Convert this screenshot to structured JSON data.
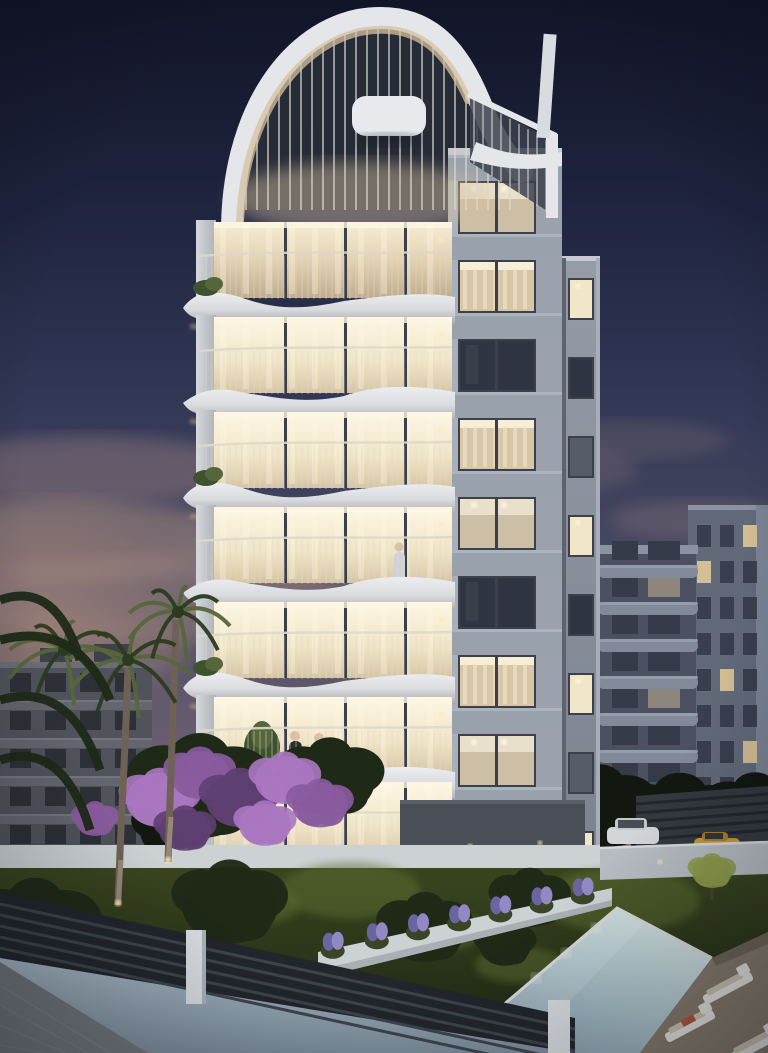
{
  "scene": {
    "type": "architectural-render",
    "time_of_day": "dusk",
    "subject": "modern-apartment-tower-with-curved-balconies-garden-and-pool",
    "colors": {
      "sky_top": "#121527",
      "sky_upper": "#1f2440",
      "sky_mid": "#343a57",
      "sky_lower": "#4a4a63",
      "sky_mauve": "#635a6e",
      "sky_warm": "#7d6c74",
      "sky_horizon": "#97837e",
      "cloud": "#8d767a",
      "cloud_warm": "#a2887f",
      "sunset": "#f2bc80",
      "sunset_deep": "#df9f66",
      "facade_top": "#9aa2ae",
      "facade_mid": "#8b93a0",
      "facade_bottom": "#6b7280",
      "spandrel": "#99a1ad",
      "pilaster": "#a9b0bb",
      "parapet": "#c6cad0",
      "mullion": "#3b404b",
      "window_dark": "#2f3542",
      "window_dim": "#565c68",
      "window_lit": "#f2e6c8",
      "window_bright": "#fdf6e0",
      "glass_warm": "#d8c6a8",
      "balcony_face": "#eceef0",
      "balcony_mid": "#c2c4c9",
      "balcony_shade": "#97989e",
      "railing": "#ded8ca",
      "underglow": "#c8ab80",
      "crown_white": "#e4e6ea",
      "crown_warm": "#d6c2a0",
      "roof_recess": "#262b38",
      "bgL_face": "#50535b",
      "bgL_band": "#63666e",
      "bgL_roof": "#3e4149",
      "bgL_window": "#2b2e35",
      "bgR_tower": "#626a79",
      "bgR_tower2": "#7b8495",
      "bgR_recess": "#4b5160",
      "bgR_band": "#828a99",
      "bgR_band_hi": "#98a0ae",
      "bgR_window": "#353b49",
      "bgR_window_lit": "#d9c497",
      "treeline": "#12170f",
      "foliage": "#1f2917",
      "palm": "#2c3a20",
      "palm_lit": "#55663a",
      "trunk": "#6e6156",
      "trunk_lit": "#a2927f",
      "lawn_top": "#3a451f",
      "lawn_bottom": "#1c2412",
      "lawn_lit": "#5f6e33",
      "bougainvillea": "#8a5b9e",
      "bougainvillea_hi": "#aa77c0",
      "bougainvillea_dark": "#5e3f72",
      "lavender": "#9289c4",
      "lavender_dark": "#6a64a0",
      "wall_white": "#ccd1d4",
      "wall_white_shade": "#a9b0b5",
      "gate": "#4a4e56",
      "pool_light": "#cbdcdd",
      "pool_mid": "#a9c0c8",
      "pool_deep": "#7f97a6",
      "coping": "#d8d9d5",
      "deck": "#867b6c",
      "deck_dark": "#6e6557",
      "lounger": "#e6e5e0",
      "lounger_pad": "#cdc5b2",
      "towel": "#b5563c",
      "fence": "#22262c",
      "fence_slat": "#3e444c",
      "post": "#d9dce0",
      "base_wall": "#9aabb8",
      "base_wall_dark": "#7e8e9c",
      "pavement": "#73787e",
      "car_white": "#d2d6d9",
      "car_yellow": "#c79a33",
      "pergola": "#34383f",
      "glow": "#ffe9b8",
      "skin": "#d8c0a6",
      "figure_dark": "#2a2d33",
      "figure_gray": "#3a3f49",
      "figure_light": "#cfd3d8",
      "figure_purple": "#7b5fae",
      "terrace_floor": "#62665e",
      "sofa_white": "#e8e8e4"
    },
    "main_building": {
      "name": "curved-balcony-tower",
      "right_facade_floors": [
        "ceiling",
        "curtain",
        "dark",
        "curtain",
        "ceiling",
        "dark",
        "curtain",
        "ceiling",
        "dark",
        "curtain"
      ],
      "side_block_floors": [
        "lit",
        "dark",
        "dim",
        "lit",
        "dark",
        "lit",
        "dim",
        "lit"
      ],
      "balcony_levels": [
        300,
        395,
        490,
        585,
        680,
        775,
        860
      ],
      "planter_levels": [
        0,
        2,
        4
      ],
      "people": {
        "pair_on_balcony": true,
        "single_on_balcony": true,
        "person_on_terrace": true
      }
    },
    "left_building": {
      "window_rows": 5,
      "windows_per_row": 4
    },
    "right_building": {
      "balcony_bands": 7,
      "grid_rows": 8,
      "grid_cols": 3,
      "lit_windows": [
        [
          0,
          2
        ],
        [
          1,
          0
        ],
        [
          4,
          1
        ],
        [
          6,
          2
        ]
      ]
    },
    "garden": {
      "palms": [
        {
          "cx": 128,
          "cy": 660,
          "r": 62
        },
        {
          "cx": 178,
          "cy": 612,
          "r": 52
        },
        {
          "cx": 64,
          "cy": 650,
          "r": 58
        }
      ],
      "palm_trunks": [
        [
          118,
          905,
          128,
          668
        ],
        [
          168,
          862,
          176,
          620
        ]
      ],
      "bushes": [
        {
          "cx": 230,
          "cy": 905,
          "r": 48
        },
        {
          "cx": 425,
          "cy": 930,
          "r": 40
        },
        {
          "cx": 530,
          "cy": 900,
          "r": 34
        },
        {
          "cx": 35,
          "cy": 930,
          "r": 55
        },
        {
          "cx": 505,
          "cy": 945,
          "r": 26
        }
      ],
      "lavender_positions": [
        0.05,
        0.2,
        0.34,
        0.48,
        0.62,
        0.76,
        0.9
      ],
      "cars": [
        "white-suv",
        "yellow-sports-car"
      ],
      "lit_tree": {
        "cx": 712,
        "cy": 880
      }
    },
    "pool": {
      "shape": "rectangular-perspective",
      "loungers": [
        {
          "x": 728,
          "y": 988
        },
        {
          "x": 690,
          "y": 1026
        },
        {
          "x": 755,
          "y": 1046
        }
      ],
      "underwater_lights": 3
    }
  }
}
